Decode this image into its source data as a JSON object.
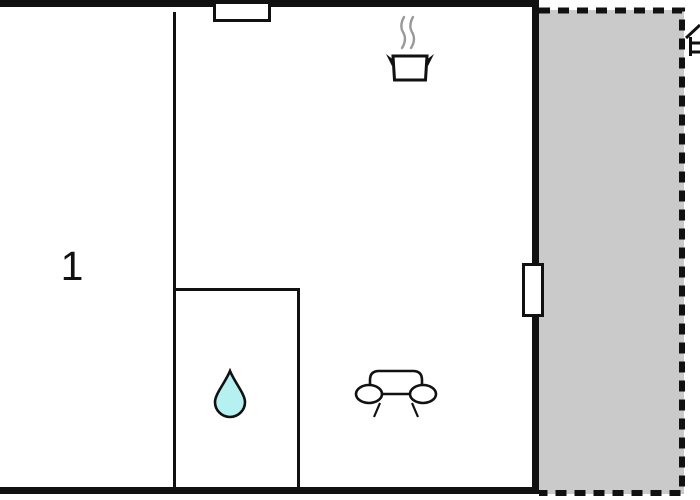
{
  "floor_plan": {
    "rooms": [
      {
        "label": "1"
      }
    ],
    "symbols": [
      {
        "name": "window-symbol"
      },
      {
        "name": "door-symbol"
      },
      {
        "name": "cooking-pot-icon"
      },
      {
        "name": "steam-icon"
      },
      {
        "name": "water-drop-icon"
      },
      {
        "name": "sofa-icon"
      },
      {
        "name": "terrace-area"
      },
      {
        "name": "partial-house-icon"
      }
    ]
  },
  "colors": {
    "wall": "#111111",
    "terrace-fill": "#cacaca",
    "drop-fill": "#b5f1f1",
    "steam": "#999999",
    "background": "#ffffff"
  }
}
